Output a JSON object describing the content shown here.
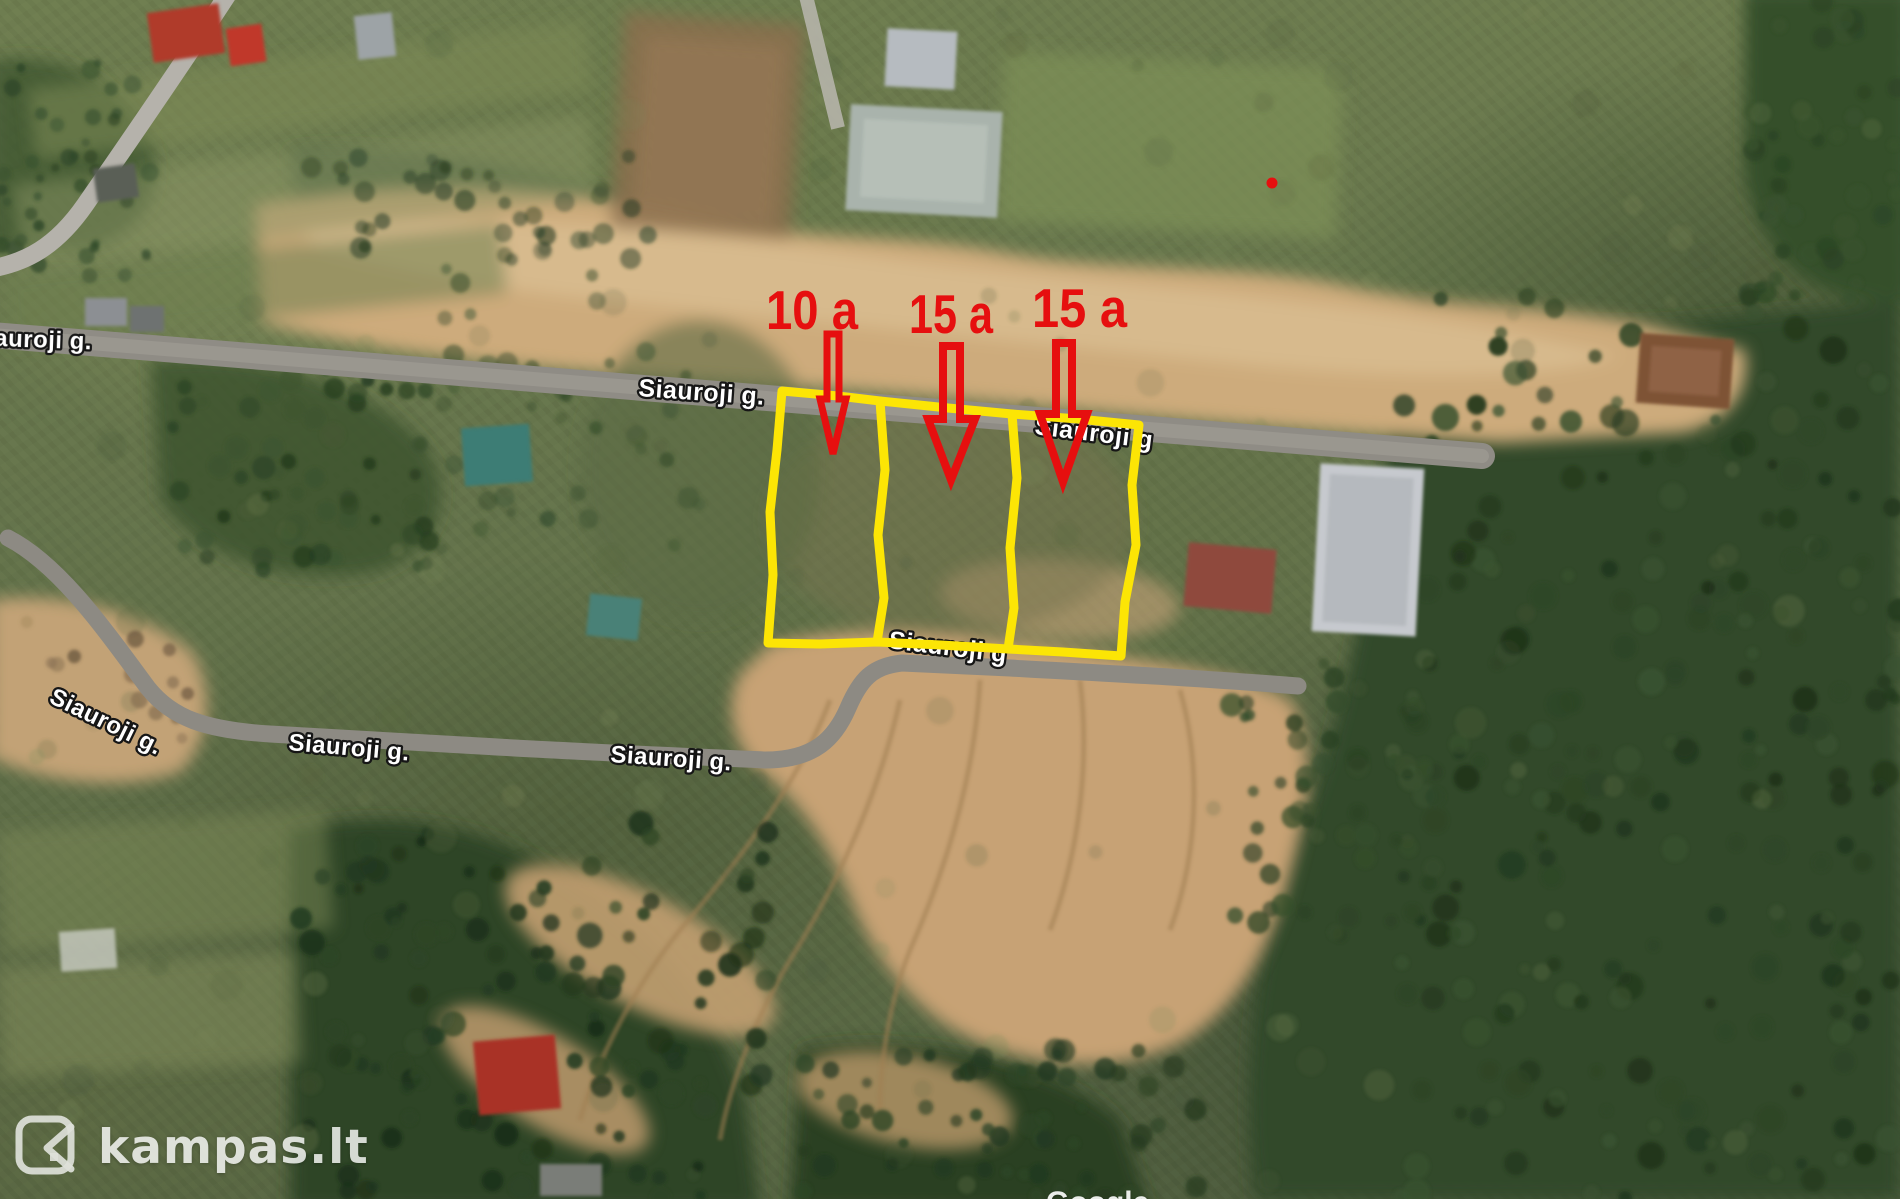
{
  "map": {
    "street_labels": [
      {
        "text": "auroji g."
      },
      {
        "text": "Siauroji g."
      },
      {
        "text": "Siauroji g"
      },
      {
        "text": "Siauroji g"
      },
      {
        "text": "Siauroji g."
      },
      {
        "text": "Siauroji g."
      },
      {
        "text": "Siauroji g."
      }
    ],
    "plot_annotations": [
      {
        "label": "10 a"
      },
      {
        "label": "15 a"
      },
      {
        "label": "15 a"
      }
    ],
    "colors": {
      "plot_outline": "#fce505",
      "annotation_red": "#e60f0f",
      "street_label_fill": "#ffffff"
    }
  },
  "watermarks": {
    "brand": "kampas.lt",
    "map_provider": "Google"
  }
}
